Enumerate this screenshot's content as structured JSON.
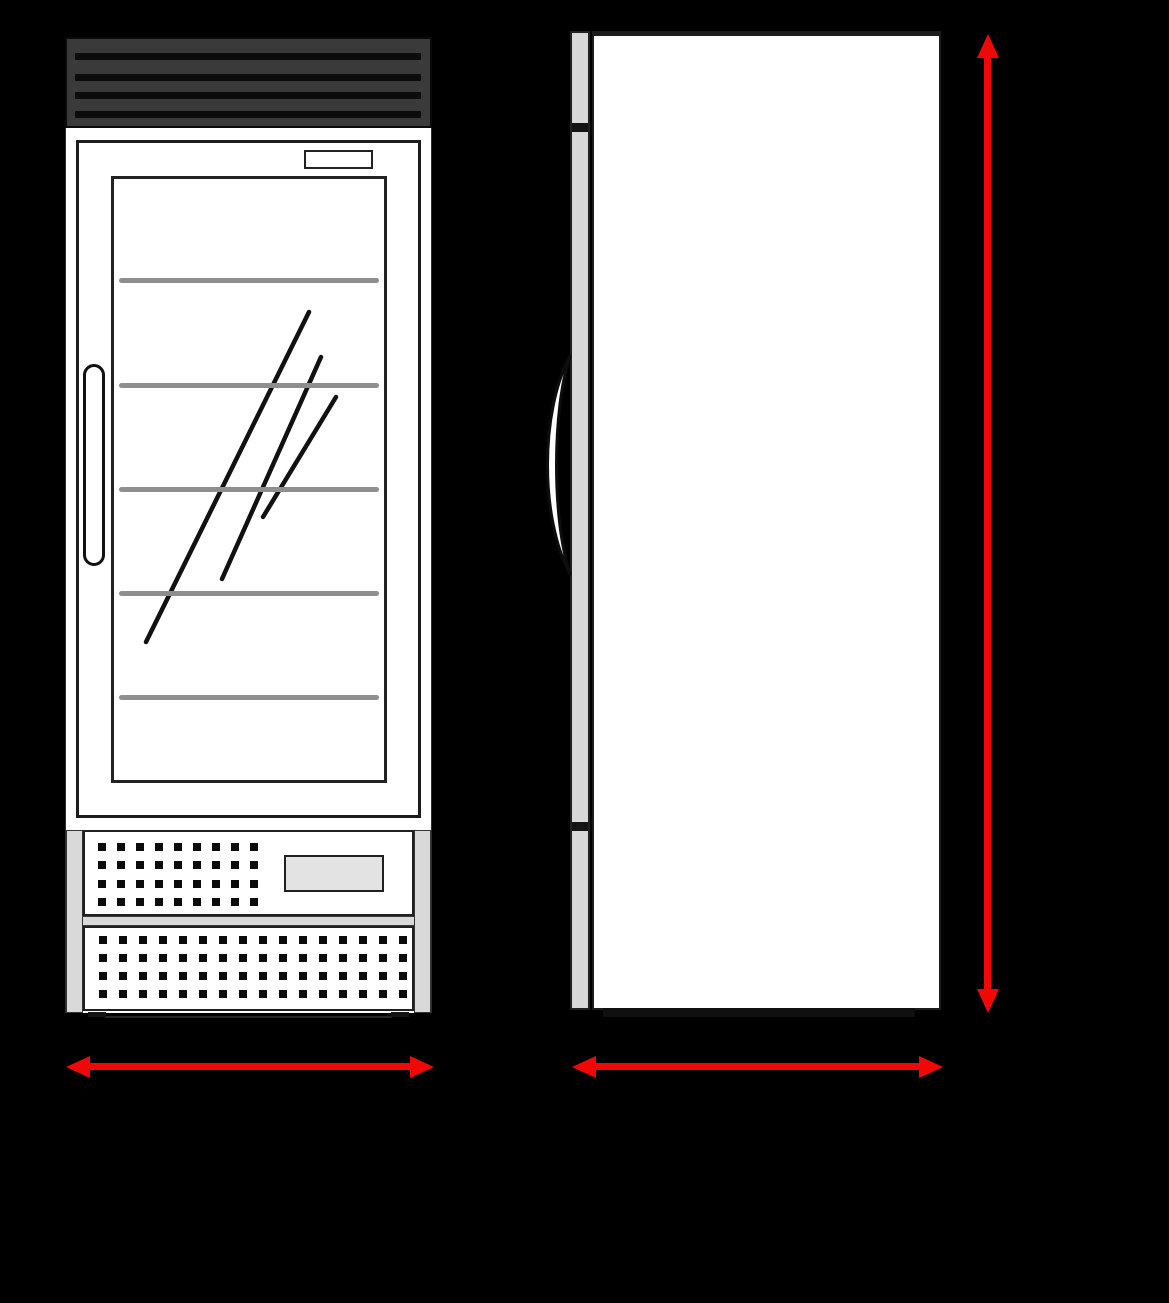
{
  "colors": {
    "background": "#000000",
    "accent_red": "#f20707",
    "cabinet_white": "#ffffff",
    "outline_dark": "#1c1c1c",
    "header_gray": "#3a3a3a",
    "slat_black": "#0c0c0c",
    "panel_light_gray": "#d9d9d9",
    "shelf_gray": "#8e8e8e",
    "plate_gray": "#e3e3e3"
  },
  "front_view": {
    "louver_slat_offsets_y": [
      14,
      35,
      53,
      72
    ],
    "shelf_offsets_y": [
      99,
      204,
      308,
      412,
      516
    ],
    "glare_lines": [
      [
        32,
        463,
        195,
        133
      ],
      [
        108,
        400,
        207,
        178
      ],
      [
        149,
        338,
        222,
        218
      ]
    ],
    "upper_vent_grid": {
      "cols": 9,
      "rows": 4,
      "pitch_x": 19,
      "pitch_y": 18.3,
      "dot_size": 8,
      "start_x": 13,
      "start_y": 11
    },
    "lower_vent_grid": {
      "cols": 16,
      "rows": 4,
      "pitch_x": 20,
      "pitch_y": 18.0,
      "dot_size": 8,
      "start_x": 14,
      "start_y": 8
    },
    "feet": [
      {
        "x": 88,
        "y": 1012,
        "w": 18
      },
      {
        "x": 391,
        "y": 1012,
        "w": 18
      }
    ]
  },
  "side_view": {
    "hinge_band_offsets_y": [
      90,
      789
    ]
  },
  "dimension_arrows": [
    {
      "id": "front-width-arrow",
      "orientation": "horizontal",
      "x": 66,
      "y": 1056,
      "length": 368
    },
    {
      "id": "side-width-arrow",
      "orientation": "horizontal",
      "x": 572,
      "y": 1056,
      "length": 371
    },
    {
      "id": "height-arrow",
      "orientation": "vertical",
      "x": 977,
      "y": 34,
      "length": 979
    }
  ]
}
